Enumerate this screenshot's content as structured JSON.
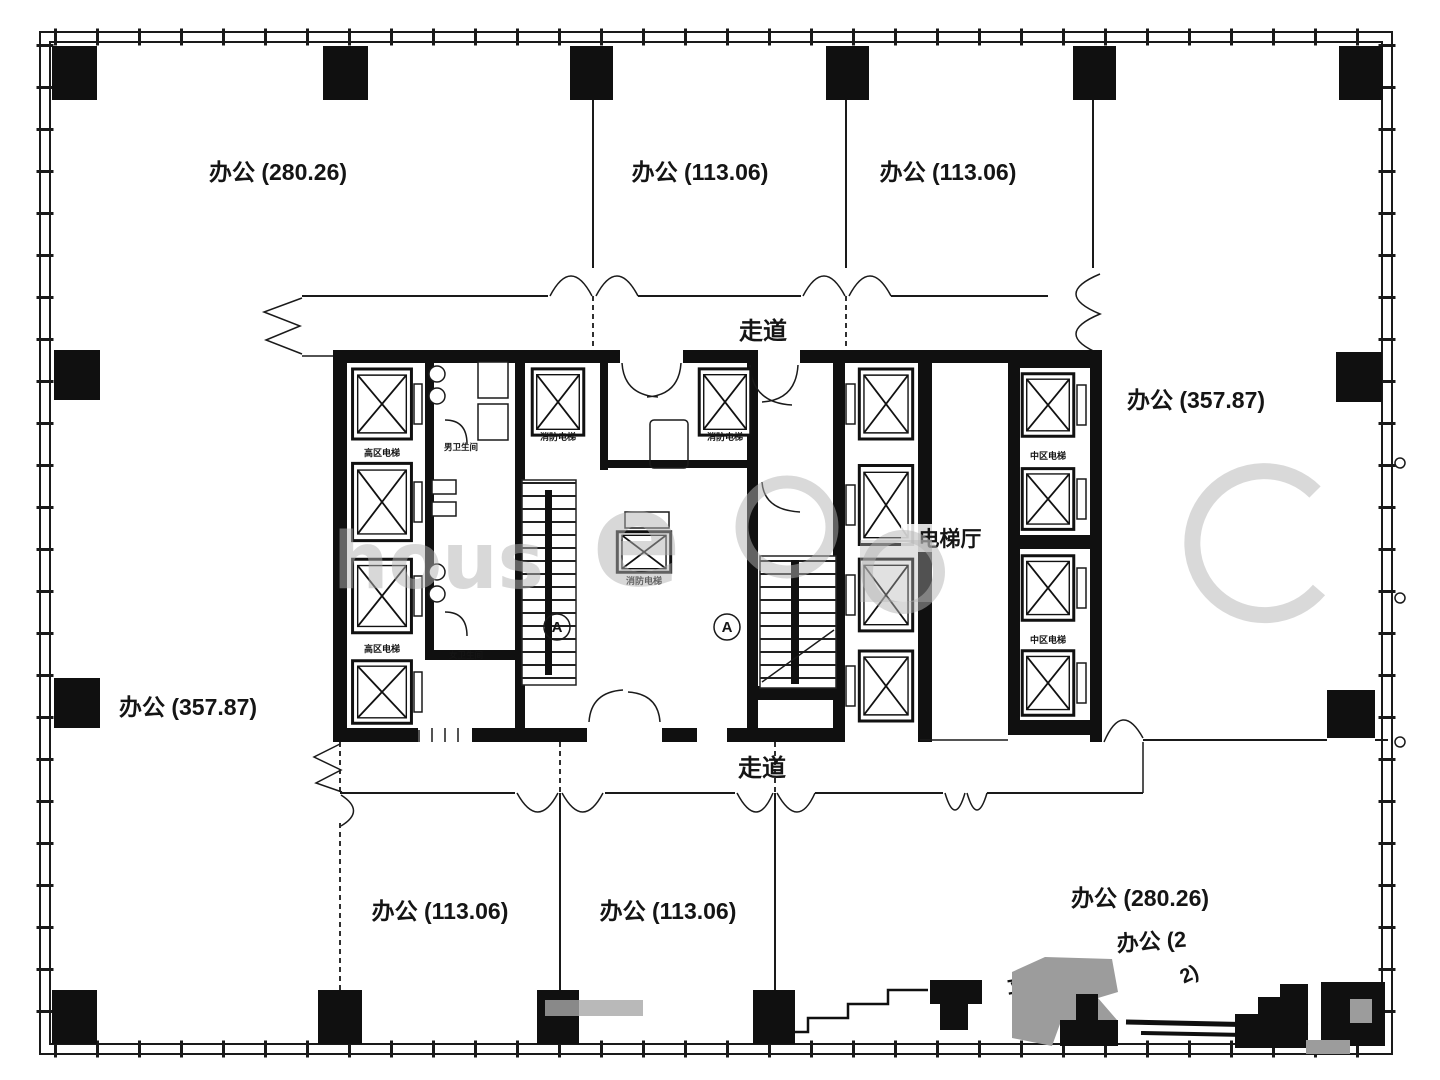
{
  "title": "office-tower-floor-plan",
  "rooms": {
    "top_left": "办公 (280.26)",
    "top_mid": "办公 (113.06)",
    "top_right": "办公 (113.06)",
    "right": "办公 (357.87)",
    "left": "办公 (357.87)",
    "bottom_left": "办公 (113.06)",
    "bottom_mid": "办公 (113.06)",
    "bottom_right": "办公 (280.26)"
  },
  "corridor": {
    "label": "走道"
  },
  "core": {
    "elevator_hall": "电梯厅",
    "high_zone_elevator": "高区电梯",
    "mid_zone_elevator": "中区电梯",
    "fire_elevator": "消防电梯",
    "mens_toilet": "男卫生间",
    "womens_toilet": "女卫生间",
    "grid_mark": "A"
  },
  "fragments": {
    "partial_room": "办公 (2",
    "partial_digits": "2)",
    "partial_glyph": "立"
  },
  "watermark": {
    "part1": "hous",
    "part2": "e"
  },
  "colors": {
    "line": "#1a1a1a",
    "solid_black": "#101010",
    "watermark_gray": "#b3b3b3",
    "artifact_gray": "#9c9c9c",
    "background": "#ffffff"
  }
}
